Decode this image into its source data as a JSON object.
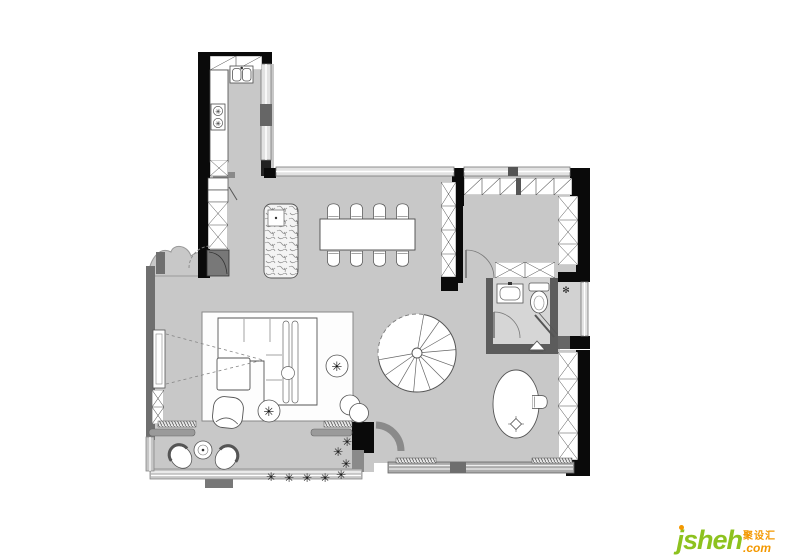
{
  "watermark": {
    "brand": "jsheh",
    "tld": ".com",
    "cjk": "聚设汇",
    "brand_color": "#8dc21f",
    "accent_color": "#f39800"
  },
  "palette": {
    "background": "#ffffff",
    "floor": "#c8c8c8",
    "floor_bathroom": "#d6d6d6",
    "floor_platform": "#d2d2d2",
    "wall_black": "#0a0a0a",
    "wall_gray": "#6f6f6f",
    "window_gray": "#e2e2e2",
    "furniture_outline": "#4a4a4a",
    "plant_color": "#111111"
  },
  "icons": {
    "plant": "✳",
    "drain": "✻",
    "burner": "✳"
  }
}
